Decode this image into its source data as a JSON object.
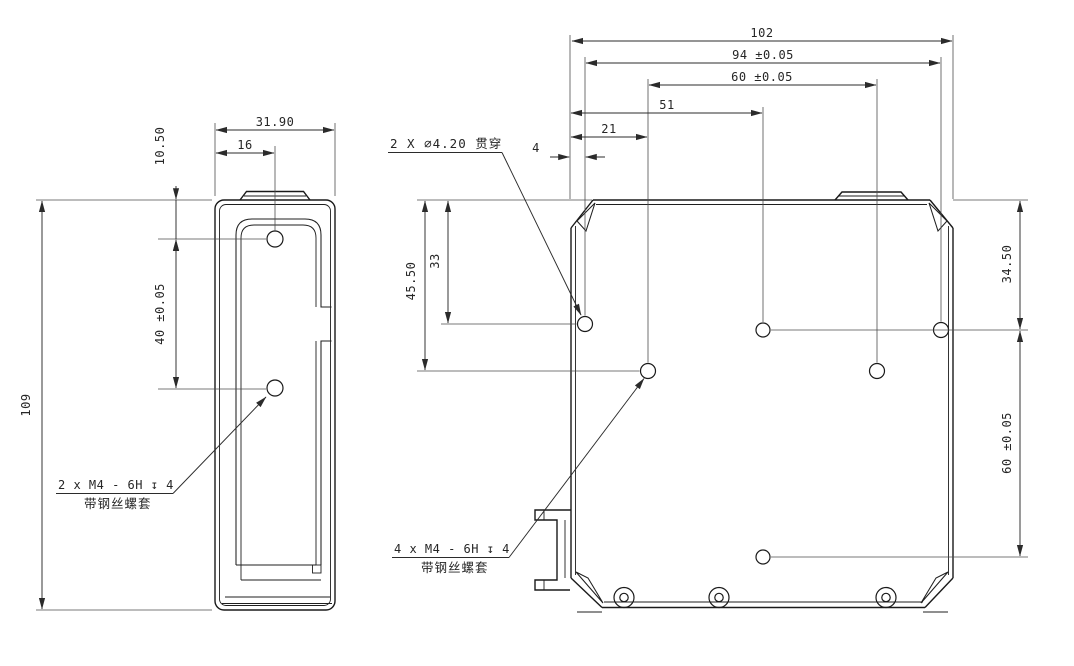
{
  "colors": {
    "outline": "#1a1a1a",
    "dimension_line": "#4d4d4d",
    "text": "#262626",
    "background": "#ffffff"
  },
  "side_view": {
    "dim_width": "31.90",
    "dim_hole_offset": "16",
    "dim_hole_from_top": "10.50",
    "dim_hole_pitch": "40 ±0.05",
    "dim_height": "109",
    "thread_note_line1": "2 x M4 - 6H ↧ 4",
    "thread_note_line2": "带钢丝螺套"
  },
  "bottom_view": {
    "dim_overall_width": "102",
    "dim_hole_span_94": "94 ±0.05",
    "dim_hole_span_60": "60 ±0.05",
    "dim_51": "51",
    "dim_21": "21",
    "dim_4": "4",
    "dim_45_50": "45.50",
    "dim_33": "33",
    "dim_34_50": "34.50",
    "dim_60_vertical": "60 ±0.05",
    "through_hole_note": "2 X ⌀4.20 贯穿",
    "thread_note_line1": "4 x M4 - 6H ↧ 4",
    "thread_note_line2": "带钢丝螺套"
  }
}
